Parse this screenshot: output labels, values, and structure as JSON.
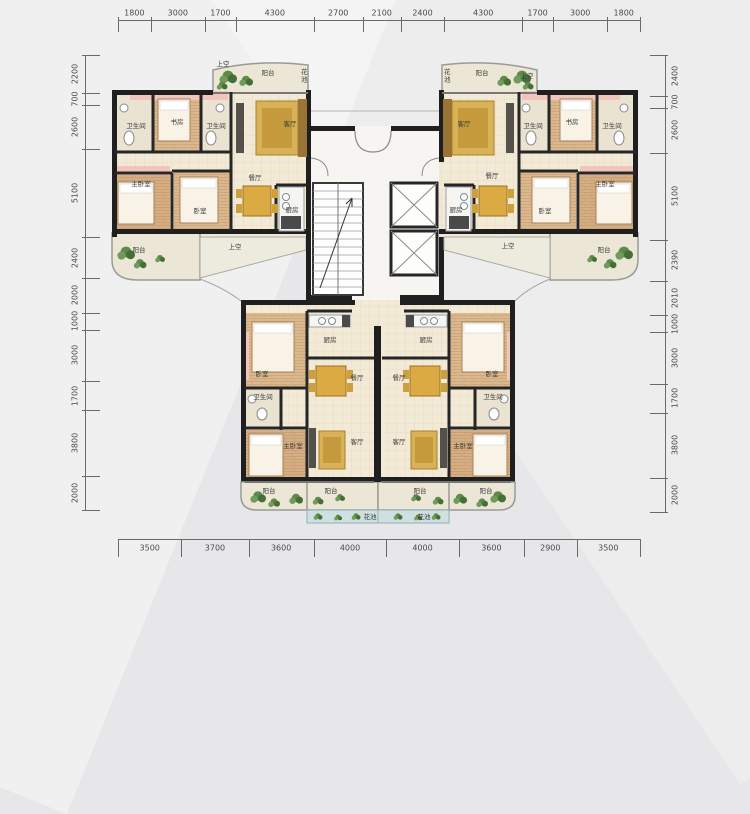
{
  "dimensions": {
    "top": [
      "1800",
      "3000",
      "1700",
      "4300",
      "2700",
      "2100",
      "2400",
      "4300",
      "1700",
      "3000",
      "1800"
    ],
    "bottom": [
      "3500",
      "3700",
      "3600",
      "4000",
      "4000",
      "3600",
      "2900",
      "3500"
    ],
    "left": [
      "2200",
      "700",
      "2600",
      "5100",
      "2400",
      "2000",
      "1000",
      "3000",
      "1700",
      "3800",
      "2000"
    ],
    "right": [
      "2400",
      "700",
      "2600",
      "5100",
      "2390",
      "2010",
      "1000",
      "3000",
      "1700",
      "3800",
      "2000"
    ]
  },
  "rooms": {
    "upper_left": {
      "bath_a": "卫生间",
      "study": "书房",
      "bath_b": "卫生间",
      "living": "客厅",
      "dining": "餐厅",
      "master": "主卧室",
      "bedroom": "卧室",
      "kitchen": "厨房",
      "balcony_top": "阳台",
      "flower_top": "花池",
      "void_top": "上空",
      "balcony": "阳台",
      "void": "上空"
    },
    "upper_right": {
      "bath_a": "卫生间",
      "study": "书房",
      "bath_b": "卫生间",
      "living": "客厅",
      "dining": "餐厅",
      "master": "主卧室",
      "bedroom": "卧室",
      "kitchen": "厨房",
      "balcony_top": "阳台",
      "flower_top": "花池",
      "void_top": "上空",
      "balcony": "阳台",
      "void": "上空"
    },
    "lower_left": {
      "kitchen": "厨房",
      "bedroom": "卧室",
      "dining": "餐厅",
      "bath": "卫生间",
      "master": "主卧室",
      "living": "客厅",
      "balcony_outer": "阳台",
      "balcony_inner": "阳台",
      "flower": "花池"
    },
    "lower_right": {
      "kitchen": "厨房",
      "bedroom": "卧室",
      "dining": "餐厅",
      "bath": "卫生间",
      "master": "主卧室",
      "living": "客厅",
      "balcony_outer": "阳台",
      "balcony_inner": "阳台",
      "flower": "花池"
    }
  },
  "colors": {
    "wall": "#1f1f1f",
    "floor": "#f2ead6",
    "wood": "#dcb88e",
    "closet_pink": "#f1c5bc",
    "furniture_gold": "#d9b258",
    "plant_green": "#5d8a4a",
    "flower_bed": "#cfe0e2",
    "background": "#e7e7e9",
    "dimension_text": "#4a4a4a"
  }
}
